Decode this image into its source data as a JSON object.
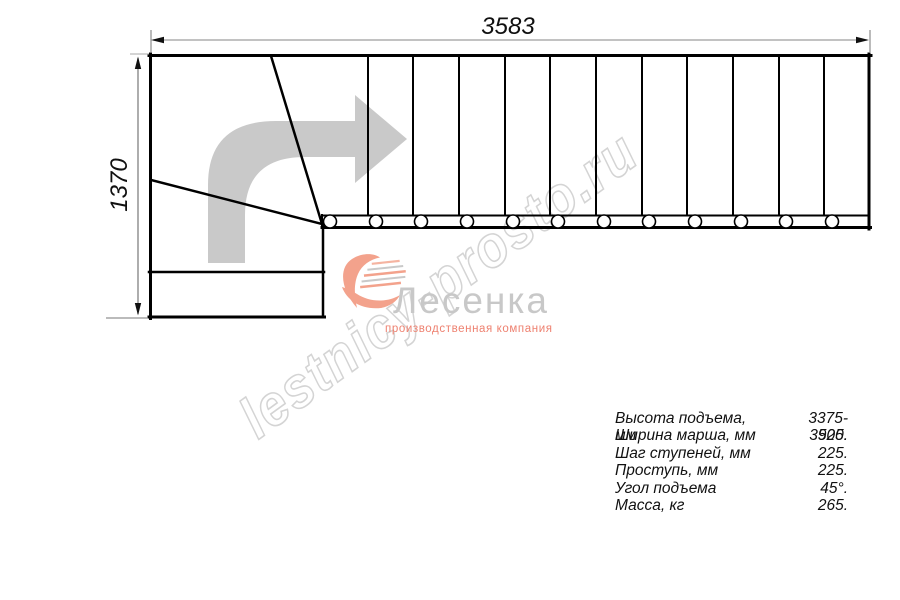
{
  "dimensions": {
    "top_width_mm": "3583",
    "left_height_mm": "1370"
  },
  "watermark": {
    "text": "lestnicy-prosto.ru"
  },
  "logo": {
    "name": "Лесенка",
    "tagline": "производственная компания"
  },
  "specs": {
    "rows": [
      {
        "label": "Высота подъема, мм",
        "value": "3375-3525."
      },
      {
        "label": "Ширина марша, мм",
        "value": "900."
      },
      {
        "label": "Шаг ступеней, мм",
        "value": "225."
      },
      {
        "label": "Проступь, мм",
        "value": "225."
      },
      {
        "label": "Угол подъема",
        "value": "45°."
      },
      {
        "label": "Масса, кг",
        "value": "265."
      }
    ]
  },
  "stairs": {
    "type": "L-shaped staircase plan, top view",
    "straight_treads": 12,
    "winder_treads": 3,
    "direction": "up then right",
    "colors": {
      "outline": "#000000",
      "dimension_line": "#9e9e9e",
      "direction_arrow": "#c9c9c9",
      "watermark": "#d4d4d4",
      "logo_text": "#c8c8c8",
      "logo_accent": "#ee8170"
    }
  }
}
